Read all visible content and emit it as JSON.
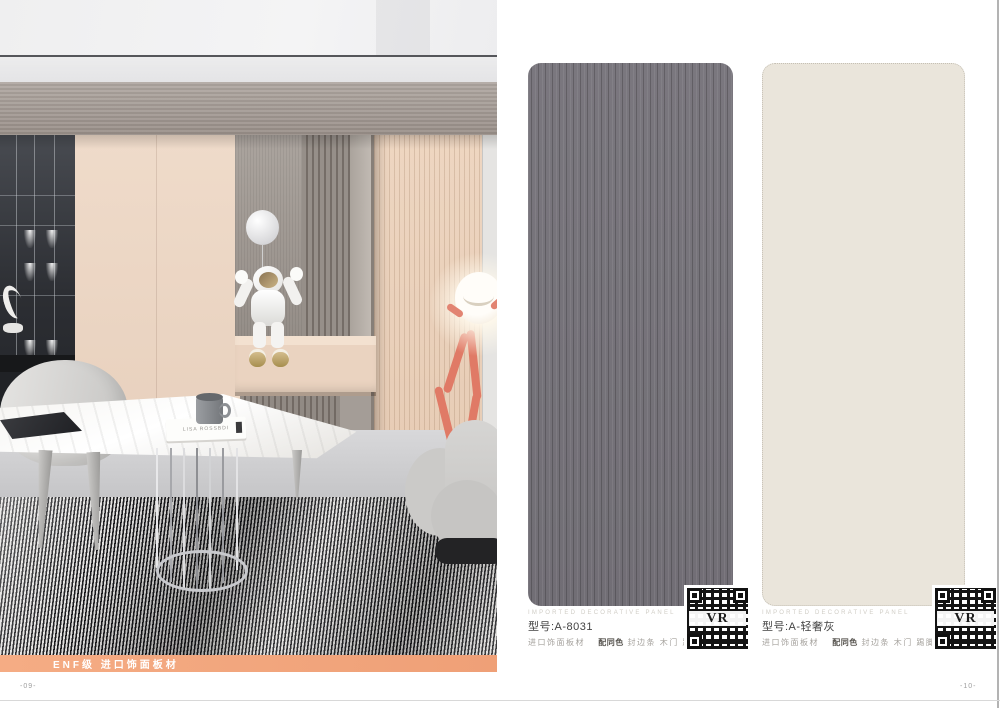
{
  "left_page": {
    "footer_bar_label": "ENF级 进口饰面板材",
    "page_number": "-09-",
    "scene": {
      "book_text": "LISA ROSSBDI"
    }
  },
  "right_page": {
    "products": [
      {
        "caption_en": "IMPORTED DECORATIVE PANEL",
        "model": "型号:A-8031",
        "material": "进口饰面板材",
        "match_bold": "配同色",
        "match_rest": "封边条 木门 踢脚线",
        "qr_text": "VR",
        "swatch_color": "#757279"
      },
      {
        "caption_en": "IMPORTED DECORATIVE PANEL",
        "model": "型号:A-轻奢灰",
        "material": "进口饰面板材",
        "match_bold": "配同色",
        "match_rest": "封边条 木门 踢脚线",
        "qr_text": "VR",
        "swatch_color": "#eae5db"
      }
    ],
    "page_number": "-10-"
  },
  "colors": {
    "accent_orange": "#f2a57c",
    "swatch_gray": "#757279",
    "swatch_cream": "#eae5db"
  }
}
